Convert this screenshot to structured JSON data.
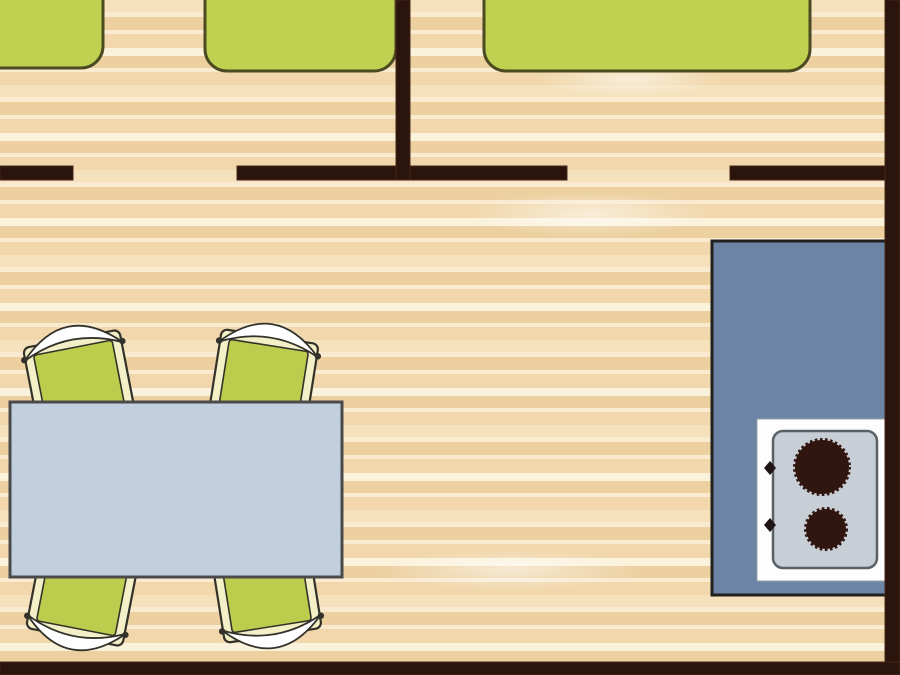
{
  "scene": {
    "name": "mobile-home-floor-plan",
    "width": 900,
    "height": 675
  },
  "palette": {
    "wall": "#2b140b",
    "wall_edge": "#46281a",
    "floor_base": "#f1d7ab",
    "floor_mid": "#f5e2bd",
    "floor_dark": "#ecd0a0",
    "floor_light": "#f9ead0",
    "floor_cream": "#fbf2dc",
    "bed_fill": "#c0d152",
    "bed_border": "#4b4a20",
    "chair_green": "#bccd4e",
    "chair_cream": "#f3efc6",
    "chair_outline": "#33322a",
    "chair_back_white": "#ffffff",
    "table_fill": "#c2cfdf",
    "table_border": "#4a4a4a",
    "counter_fill": "#6d85a5",
    "counter_border": "#20201e",
    "stove_body": "#fdfdfd",
    "stove_body_edge": "#9aa0a5",
    "stove_panel": "#c8ced5",
    "stove_panel_border": "#596066",
    "burner": "#31150f",
    "knob": "#1e1414"
  },
  "floor": {
    "stripes": [
      [
        "floor_mid",
        12
      ],
      [
        "floor_light",
        5
      ],
      [
        "floor_dark",
        13
      ],
      [
        "floor_light",
        4
      ],
      [
        "floor_base",
        14
      ],
      [
        "floor_cream",
        8
      ],
      [
        "floor_dark",
        12
      ],
      [
        "floor_light",
        4
      ],
      [
        "floor_base",
        13
      ]
    ],
    "highlights": [
      {
        "x": 470,
        "y": 192,
        "w": 240,
        "h": 44
      },
      {
        "x": 10,
        "y": 470,
        "w": 200,
        "h": 44
      },
      {
        "x": 380,
        "y": 550,
        "w": 260,
        "h": 40
      },
      {
        "x": 540,
        "y": 62,
        "w": 180,
        "h": 34
      }
    ]
  },
  "walls": [
    {
      "name": "wall-top-left-segment",
      "x": 0,
      "y": 166,
      "w": 73,
      "h": 14
    },
    {
      "name": "wall-top-mid-segment",
      "x": 237,
      "y": 166,
      "w": 330,
      "h": 14
    },
    {
      "name": "wall-top-right-segment",
      "x": 730,
      "y": 166,
      "w": 170,
      "h": 14
    },
    {
      "name": "wall-bedroom-divider",
      "x": 396,
      "y": 0,
      "w": 14,
      "h": 180
    },
    {
      "name": "wall-right",
      "x": 885,
      "y": 0,
      "w": 15,
      "h": 675
    },
    {
      "name": "wall-bottom",
      "x": 0,
      "y": 662,
      "w": 900,
      "h": 13
    }
  ],
  "beds": [
    {
      "name": "bed-left",
      "x": -60,
      "y": -40,
      "w": 163,
      "h": 108,
      "r": 22
    },
    {
      "name": "bed-middle",
      "x": 205,
      "y": -40,
      "w": 191,
      "h": 111,
      "r": 22
    },
    {
      "name": "bed-double",
      "x": 484,
      "y": -40,
      "w": 326,
      "h": 111,
      "r": 22
    }
  ],
  "chairs": [
    {
      "name": "chair-top-left",
      "transform": "translate(80,385) rotate(-11)"
    },
    {
      "name": "chair-top-right",
      "transform": "translate(263,383) rotate(9)"
    },
    {
      "name": "chair-bottom-left",
      "transform": "translate(83,591) scale(1,-1) rotate(-11)"
    },
    {
      "name": "chair-bottom-right",
      "transform": "translate(266,589) scale(1,-1) rotate(9)"
    }
  ],
  "chair_geometry": {
    "seat_outer": {
      "x": -49,
      "y": -47,
      "w": 98,
      "h": 92,
      "r": 6
    },
    "seat_inner": {
      "x": -40,
      "y": -38,
      "w": 80,
      "h": 76,
      "r": 3
    },
    "back_path": "M -50 -34 Q 0 -85 50 -34 Q 0 -58 -50 -34 Z",
    "back_knob_r": 3.2,
    "back_knobs": [
      {
        "cx": -50,
        "cy": -35
      },
      {
        "cx": 50,
        "cy": -35
      }
    ]
  },
  "dining_table": {
    "name": "dining-table",
    "x": 10,
    "y": 402,
    "w": 332,
    "h": 175
  },
  "kitchen_counter": {
    "name": "kitchen-counter",
    "x": 712,
    "y": 241,
    "w": 182,
    "h": 354
  },
  "stove": {
    "body": {
      "x": 757,
      "y": 419,
      "w": 130,
      "h": 162
    },
    "panel": {
      "x": 773,
      "y": 431,
      "w": 104,
      "h": 137,
      "r": 10
    },
    "burners": [
      {
        "name": "burner-large",
        "cx": 822,
        "cy": 467,
        "r": 27
      },
      {
        "name": "burner-small",
        "cx": 826,
        "cy": 529,
        "r": 20
      }
    ],
    "knobs": [
      {
        "name": "stove-knob-top",
        "cx": 770,
        "cy": 468
      },
      {
        "name": "stove-knob-bottom",
        "cx": 770,
        "cy": 525
      }
    ]
  }
}
